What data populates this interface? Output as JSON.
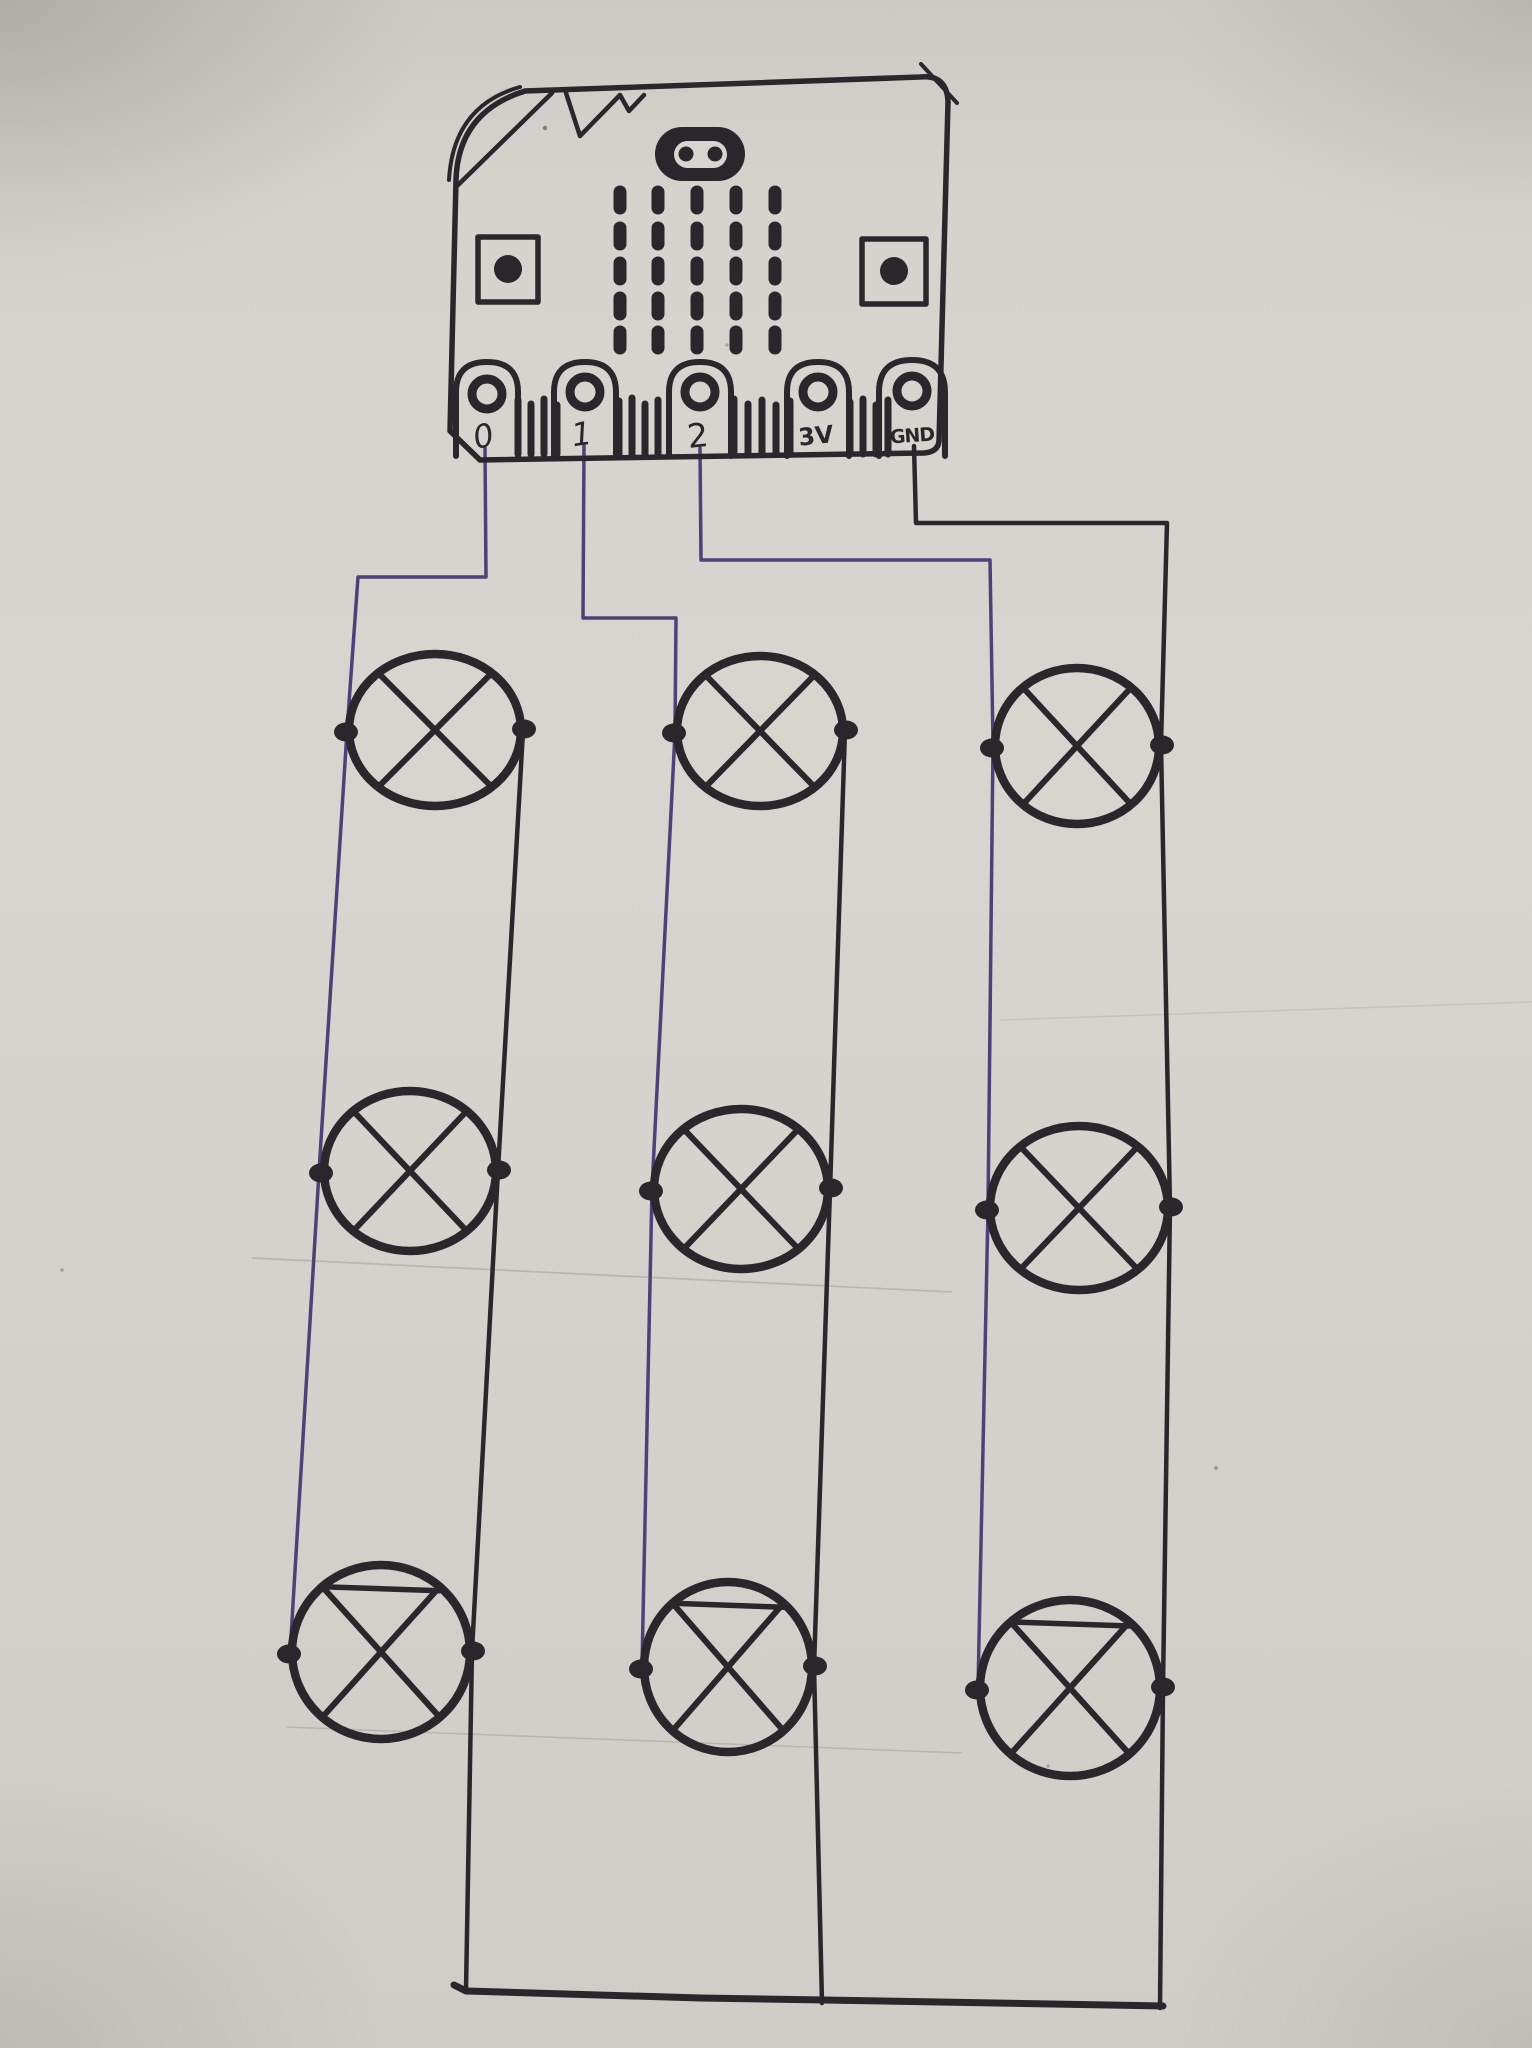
{
  "board": {
    "pins": [
      {
        "label": "0"
      },
      {
        "label": "1"
      },
      {
        "label": "2"
      },
      {
        "label": "3V"
      },
      {
        "label": "GND"
      }
    ]
  },
  "colors": {
    "paper": "#d5d2cd",
    "ink": "#2a272c",
    "purple": "#4c4277"
  },
  "circuit": {
    "lamp_rows": 3,
    "lamp_columns": 3,
    "lamp_symbol": "circle-with-x",
    "lamps": [
      {
        "name": "lamp-r1c1",
        "cx": 435,
        "cy": 730,
        "rx": 86,
        "ry": 76,
        "top_chord": false
      },
      {
        "name": "lamp-r1c2",
        "cx": 760,
        "cy": 731,
        "rx": 83,
        "ry": 75,
        "top_chord": false
      },
      {
        "name": "lamp-r1c3",
        "cx": 1077,
        "cy": 746,
        "rx": 82,
        "ry": 78,
        "top_chord": false
      },
      {
        "name": "lamp-r2c1",
        "cx": 410,
        "cy": 1171,
        "rx": 86,
        "ry": 80,
        "top_chord": false
      },
      {
        "name": "lamp-r2c2",
        "cx": 741,
        "cy": 1189,
        "rx": 87,
        "ry": 80,
        "top_chord": false
      },
      {
        "name": "lamp-r2c3",
        "cx": 1079,
        "cy": 1208,
        "rx": 89,
        "ry": 82,
        "top_chord": false
      },
      {
        "name": "lamp-r3c1",
        "cx": 381,
        "cy": 1652,
        "rx": 89,
        "ry": 87,
        "top_chord": true
      },
      {
        "name": "lamp-r3c2",
        "cx": 728,
        "cy": 1667,
        "rx": 84,
        "ry": 85,
        "top_chord": true
      },
      {
        "name": "lamp-r3c3",
        "cx": 1070,
        "cy": 1688,
        "rx": 90,
        "ry": 88,
        "top_chord": true
      }
    ],
    "wires": [
      {
        "name": "wire-pin0-left-rail-col1",
        "color": "purple",
        "width": 3.5,
        "points": [
          [
            485,
            448
          ],
          [
            486,
            577
          ],
          [
            358,
            577
          ],
          [
            347,
            731
          ],
          [
            319,
            1172
          ],
          [
            290,
            1654
          ]
        ]
      },
      {
        "name": "wire-pin1-left-rail-col2",
        "color": "purple",
        "width": 3.5,
        "points": [
          [
            584,
            446
          ],
          [
            583,
            618
          ],
          [
            676,
            618
          ],
          [
            675,
            733
          ],
          [
            652,
            1189
          ],
          [
            642,
            1666
          ]
        ]
      },
      {
        "name": "wire-pin2-left-rail-col3",
        "color": "purple",
        "width": 3.5,
        "points": [
          [
            700,
            448
          ],
          [
            701,
            560
          ],
          [
            990,
            560
          ],
          [
            993,
            744
          ],
          [
            988,
            1209
          ],
          [
            978,
            1688
          ]
        ]
      },
      {
        "name": "wire-gnd-right-rail-col3",
        "color": "ink",
        "width": 4.5,
        "points": [
          [
            914,
            446
          ],
          [
            916,
            523
          ],
          [
            1167,
            523
          ],
          [
            1161,
            744
          ],
          [
            1170,
            1207
          ],
          [
            1163,
            1687
          ],
          [
            1160,
            2008
          ]
        ]
      },
      {
        "name": "right-rail-col1",
        "color": "ink",
        "width": 4.5,
        "points": [
          [
            523,
            731
          ],
          [
            498,
            1170
          ],
          [
            472,
            1651
          ],
          [
            466,
            1990
          ]
        ]
      },
      {
        "name": "right-rail-col2",
        "color": "ink",
        "width": 4.5,
        "points": [
          [
            845,
            730
          ],
          [
            830,
            1190
          ],
          [
            814,
            1667
          ],
          [
            822,
            2003
          ]
        ]
      },
      {
        "name": "ground-bus",
        "color": "ink",
        "width": 7,
        "points": [
          [
            454,
            1985
          ],
          [
            466,
            1991
          ],
          [
            700,
            1998
          ],
          [
            824,
            2000
          ],
          [
            1163,
            2006
          ]
        ]
      }
    ]
  }
}
